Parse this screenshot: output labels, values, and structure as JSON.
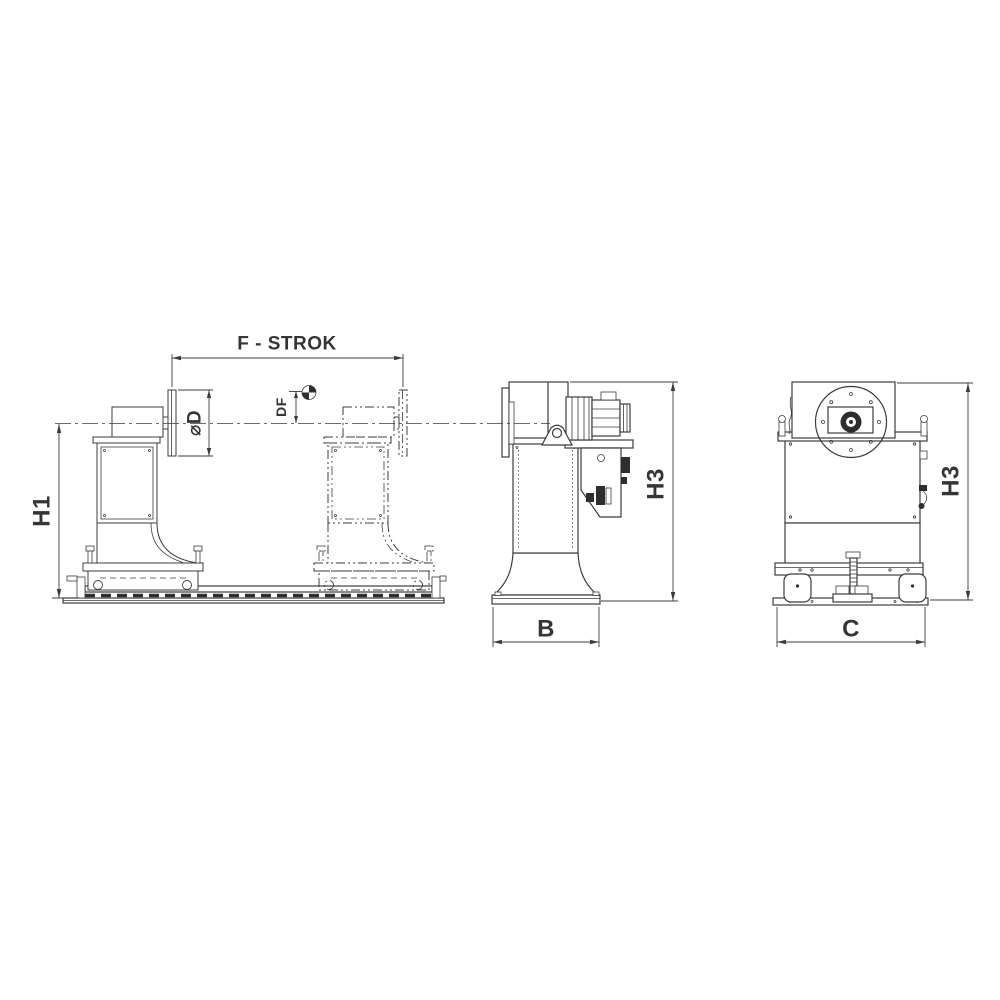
{
  "drawing": {
    "background_color": "#ffffff",
    "line_color": "#3c3c3c",
    "dark_fill_color": "#2e2e2e",
    "dimensions": {
      "f_strok": "F - STROK",
      "diameter_d": "⌀D",
      "df": "DF",
      "h1": "H1",
      "h3_side": "H3",
      "h3_rear": "H3",
      "b": "B",
      "c": "C"
    },
    "icons": {
      "center_of_gravity": "cg-quartered-circle-icon"
    }
  }
}
